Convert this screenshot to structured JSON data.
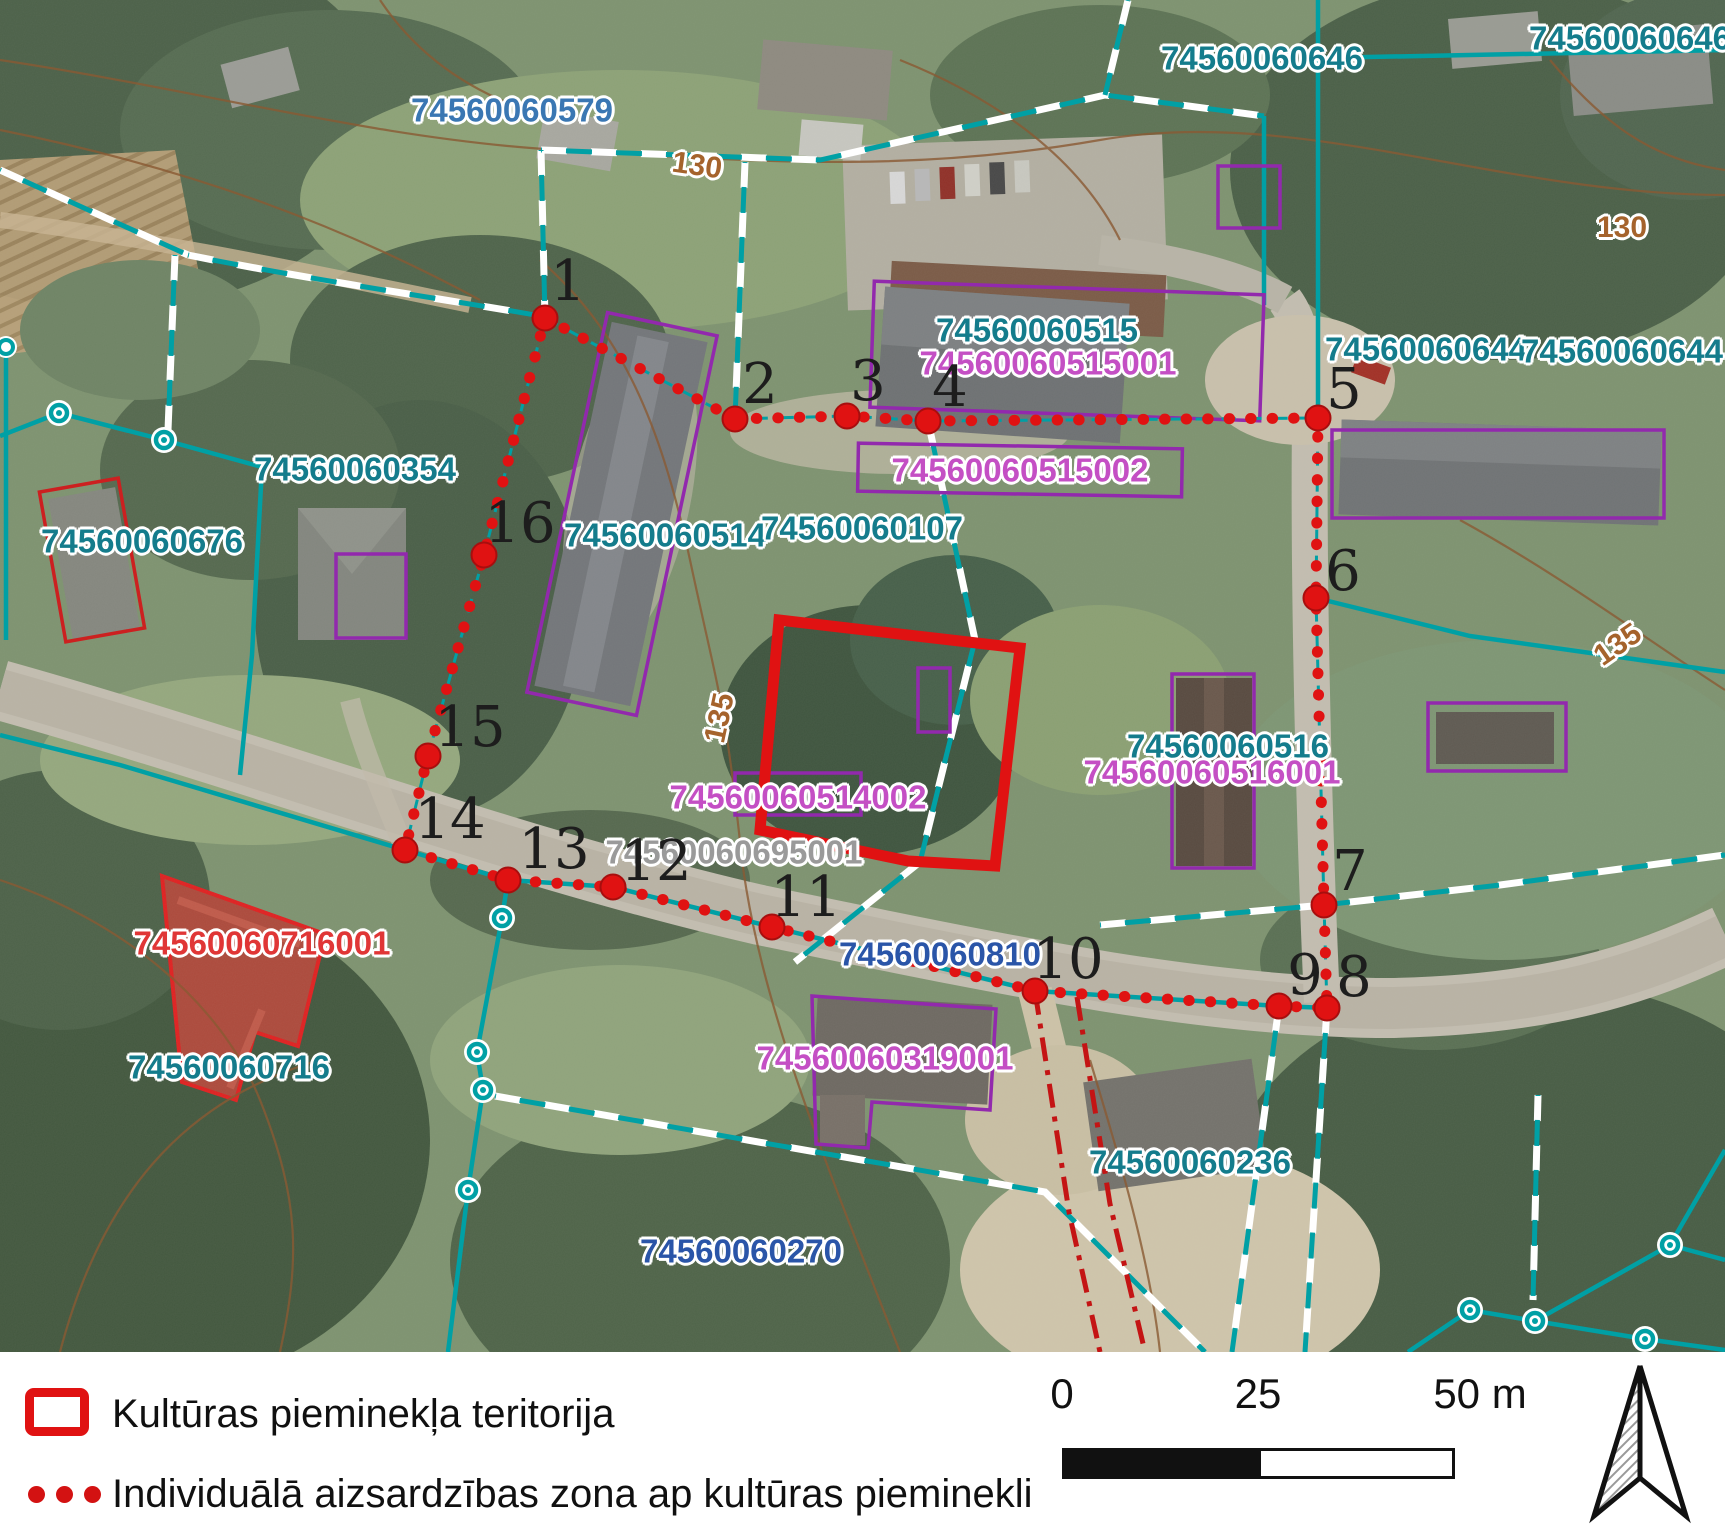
{
  "legend": {
    "items": [
      {
        "symbol": "red-rectangle",
        "label": "Kultūras pieminekļa teritorija"
      },
      {
        "symbol": "red-dotted-line",
        "label": "Individuālā aizsardzības zona ap kultūras pieminekli"
      }
    ]
  },
  "scale_bar": {
    "ticks": [
      "0",
      "25",
      "50 m"
    ]
  },
  "north_arrow": "north-arrow",
  "colors": {
    "monument_territory": "#e01212",
    "protection_zone": "#e01212",
    "parcel_boundary": "#00a0a5",
    "building_outline": "#9229ad",
    "parcel_label": "#147c8c",
    "road_label": "#2a55a8",
    "building_label": "#c44fc4",
    "monument_label": "#e03636",
    "contour_label": "#a5632c"
  },
  "map": {
    "labels": [
      {
        "text": "74560060579",
        "x": 512,
        "y": 110,
        "type": "blue",
        "name": "parcel-label"
      },
      {
        "text": "74560060646",
        "x": 1262,
        "y": 58,
        "type": "teal",
        "name": "parcel-label"
      },
      {
        "text": "74560060646",
        "x": 1630,
        "y": 38,
        "type": "teal",
        "name": "parcel-label"
      },
      {
        "text": "74560060515",
        "x": 1037,
        "y": 330,
        "type": "teal",
        "name": "parcel-label"
      },
      {
        "text": "74560060515001",
        "x": 1048,
        "y": 363,
        "type": "magenta",
        "name": "building-label"
      },
      {
        "text": "74560060644",
        "x": 1426,
        "y": 349,
        "type": "teal",
        "name": "parcel-label"
      },
      {
        "text": "74560060644",
        "x": 1622,
        "y": 351,
        "type": "teal",
        "name": "parcel-label"
      },
      {
        "text": "74560060515002",
        "x": 1020,
        "y": 470,
        "type": "magenta",
        "name": "building-label"
      },
      {
        "text": "74560060354",
        "x": 355,
        "y": 469,
        "type": "teal",
        "name": "parcel-label"
      },
      {
        "text": "74560060676",
        "x": 142,
        "y": 541,
        "type": "teal",
        "name": "parcel-label"
      },
      {
        "text": "74560060514",
        "x": 665,
        "y": 535,
        "type": "teal",
        "name": "parcel-label"
      },
      {
        "text": "74560060107",
        "x": 862,
        "y": 528,
        "type": "teal",
        "name": "parcel-label"
      },
      {
        "text": "74560060516",
        "x": 1228,
        "y": 746,
        "type": "teal",
        "name": "parcel-label"
      },
      {
        "text": "74560060516001",
        "x": 1212,
        "y": 772,
        "type": "magenta",
        "name": "building-label"
      },
      {
        "text": "74560060514002",
        "x": 798,
        "y": 797,
        "type": "magenta",
        "name": "building-label"
      },
      {
        "text": "74560060695001",
        "x": 734,
        "y": 852,
        "type": "muted",
        "name": "building-label"
      },
      {
        "text": "74560060810",
        "x": 940,
        "y": 954,
        "type": "navy",
        "name": "road-parcel-label"
      },
      {
        "text": "74560060716001",
        "x": 262,
        "y": 943,
        "type": "red",
        "name": "monument-building-label"
      },
      {
        "text": "74560060716",
        "x": 229,
        "y": 1067,
        "type": "teal",
        "name": "parcel-label"
      },
      {
        "text": "74560060319001",
        "x": 885,
        "y": 1058,
        "type": "magenta",
        "name": "building-label"
      },
      {
        "text": "74560060236",
        "x": 1190,
        "y": 1162,
        "type": "teal",
        "name": "parcel-label"
      },
      {
        "text": "74560060270",
        "x": 741,
        "y": 1251,
        "type": "navy",
        "name": "road-parcel-label"
      }
    ],
    "contour_labels": [
      {
        "text": "130",
        "x": 697,
        "y": 166,
        "rot": 8,
        "name": "contour-label"
      },
      {
        "text": "130",
        "x": 1622,
        "y": 228,
        "rot": 0,
        "name": "contour-label"
      },
      {
        "text": "135",
        "x": 720,
        "y": 718,
        "rot": -78,
        "name": "contour-label"
      },
      {
        "text": "135",
        "x": 1618,
        "y": 645,
        "rot": -35,
        "name": "contour-label"
      }
    ],
    "protection_zone_points": [
      {
        "n": "1",
        "x": 545,
        "y": 318,
        "lx": 568,
        "ly": 282
      },
      {
        "n": "2",
        "x": 735,
        "y": 419,
        "lx": 760,
        "ly": 385
      },
      {
        "n": "3",
        "x": 847,
        "y": 416,
        "lx": 868,
        "ly": 382
      },
      {
        "n": "4",
        "x": 928,
        "y": 421,
        "lx": 950,
        "ly": 388
      },
      {
        "n": "5",
        "x": 1318,
        "y": 418,
        "lx": 1344,
        "ly": 390
      },
      {
        "n": "6",
        "x": 1316,
        "y": 598,
        "lx": 1343,
        "ly": 572
      },
      {
        "n": "7",
        "x": 1324,
        "y": 905,
        "lx": 1350,
        "ly": 872
      },
      {
        "n": "8",
        "x": 1327,
        "y": 1008,
        "lx": 1354,
        "ly": 978
      },
      {
        "n": "9",
        "x": 1279,
        "y": 1006,
        "lx": 1305,
        "ly": 976
      },
      {
        "n": "10",
        "x": 1035,
        "y": 991,
        "lx": 1068,
        "ly": 960
      },
      {
        "n": "11",
        "x": 772,
        "y": 927,
        "lx": 806,
        "ly": 898
      },
      {
        "n": "12",
        "x": 613,
        "y": 887,
        "lx": 656,
        "ly": 862
      },
      {
        "n": "13",
        "x": 508,
        "y": 880,
        "lx": 554,
        "ly": 850
      },
      {
        "n": "14",
        "x": 405,
        "y": 850,
        "lx": 450,
        "ly": 820
      },
      {
        "n": "15",
        "x": 428,
        "y": 756,
        "lx": 470,
        "ly": 728
      },
      {
        "n": "16",
        "x": 484,
        "y": 555,
        "lx": 520,
        "ly": 524
      }
    ]
  }
}
